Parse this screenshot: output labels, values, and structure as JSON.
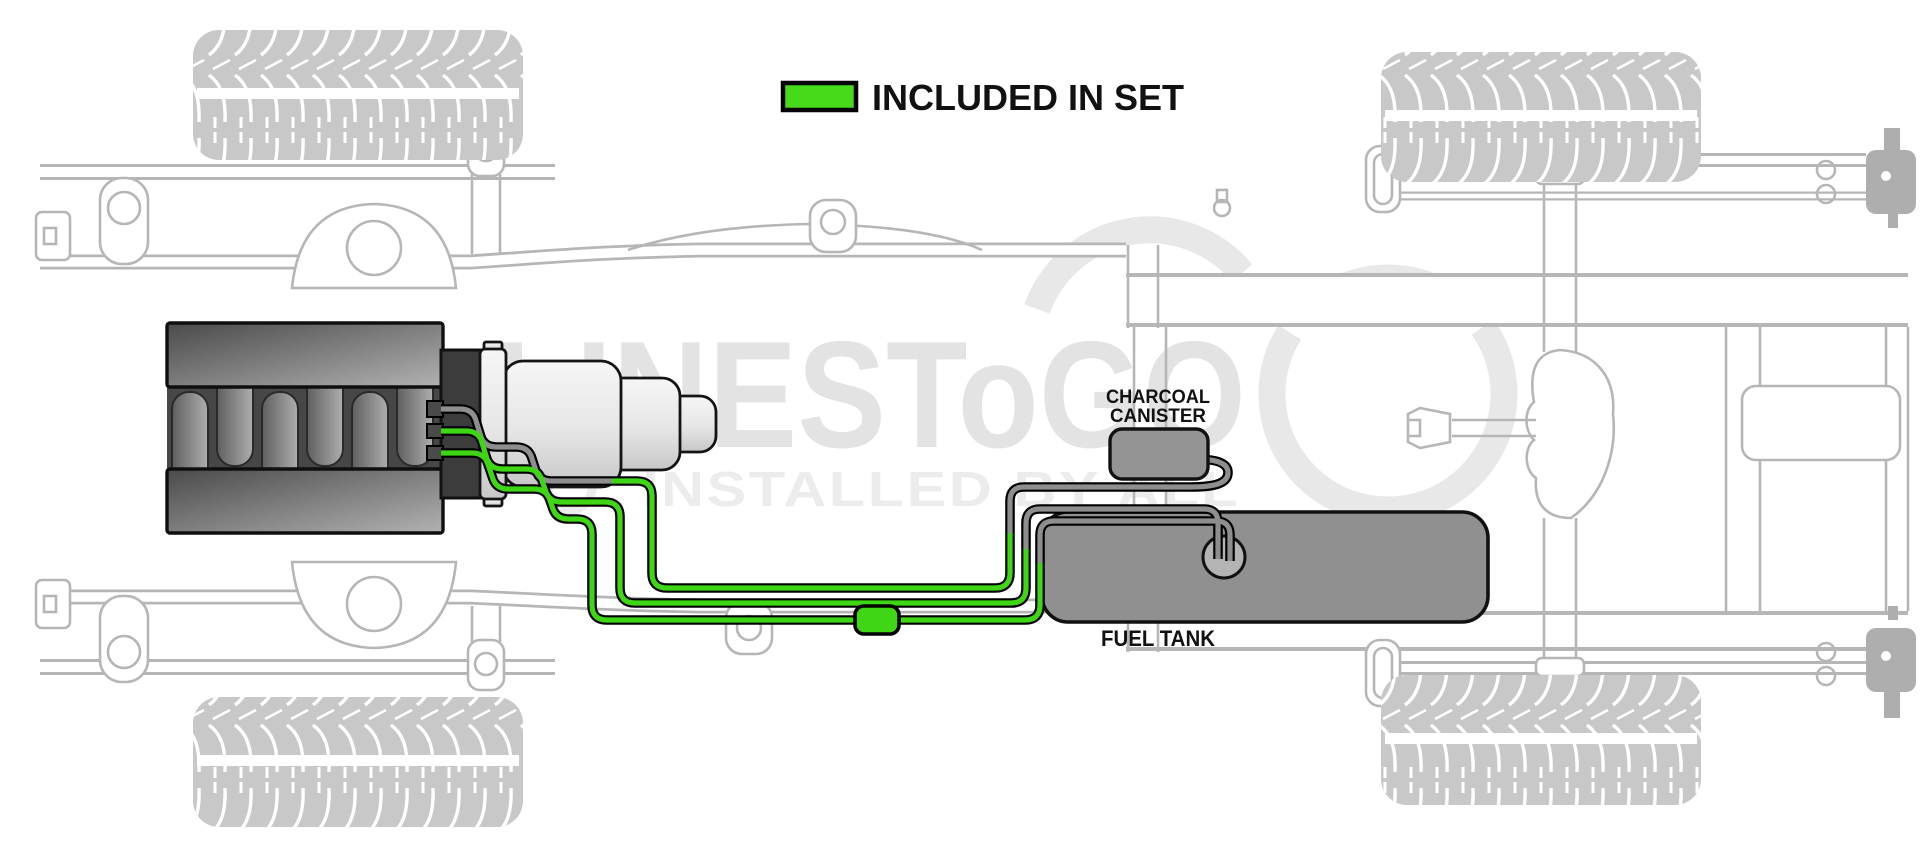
{
  "legend": {
    "label": "INCLUDED IN SET",
    "swatch_color": "#46da1b"
  },
  "watermark": {
    "brand": "LINESToGO",
    "tagline": "INSTALLED BY ALL"
  },
  "labels": {
    "charcoal_canister_line1": "CHARCOAL",
    "charcoal_canister_line2": "CANISTER",
    "fuel_tank": "FUEL TANK"
  },
  "colors": {
    "included_line_green": "#3fd615",
    "not_included_line_gray": "#8e8e8e",
    "component_gray": "#909090",
    "engine_dark": "#4a4a4a",
    "frame_outline_gray": "#b6b6b6",
    "watermark_gray": "#e3e3e3",
    "label_black": "#111111"
  },
  "components": [
    "engine",
    "transmission",
    "fuel-line-set",
    "inline-connector",
    "charcoal-canister",
    "fuel-tank",
    "fuel-pump-module",
    "chassis-frame",
    "tires"
  ]
}
